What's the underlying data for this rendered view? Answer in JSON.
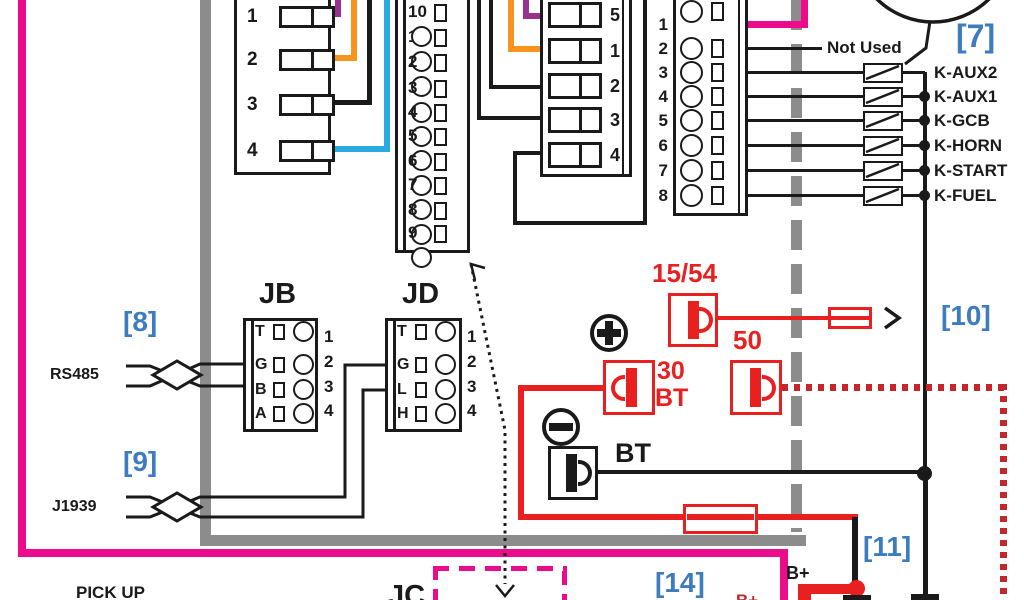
{
  "colors": {
    "magenta": "#ec0b8a",
    "gray": "#8c8c8c",
    "red": "#e8201f",
    "dark_red": "#c1272d",
    "blue_label": "#3d7dbf",
    "purple": "#97338f",
    "orange": "#f7941d",
    "light_blue": "#29abe2",
    "black": "#1a1a1a"
  },
  "labels": {
    "not_used": "Not Used",
    "pick_up": "PICK UP",
    "rs485": "RS485",
    "j1939": "J1939",
    "jb": "JB",
    "jd": "JD",
    "jc": "JC",
    "ref7": "[7]",
    "ref8": "[8]",
    "ref9": "[9]",
    "ref10": "[10]",
    "ref11": "[11]",
    "ref14": "[14]",
    "key_15_54": "15/54",
    "key_50": "50",
    "key_30": "30",
    "key_30_bt": "BT",
    "bt": "BT",
    "b_plus": "B+",
    "b_plus_partial": "B+"
  },
  "relays": [
    "K-AUX2",
    "K-AUX1",
    "K-GCB",
    "K-HORN",
    "K-START",
    "K-FUEL"
  ],
  "blocks": {
    "left4_pins": [
      "1",
      "2",
      "3",
      "4"
    ],
    "mid10_pins": [
      "1",
      "2",
      "3",
      "4",
      "5",
      "6",
      "7",
      "8",
      "9",
      "10"
    ],
    "mid5_pins": [
      "1",
      "2",
      "3",
      "4",
      "5"
    ],
    "right8_pins": [
      "1",
      "2",
      "3",
      "4",
      "5",
      "6",
      "7",
      "8"
    ],
    "jb_letters": [
      "G",
      "B",
      "A",
      "T"
    ],
    "jb_pins": [
      "1",
      "2",
      "3",
      "4"
    ],
    "jd_letters": [
      "G",
      "L",
      "H",
      "T"
    ],
    "jd_pins": [
      "1",
      "2",
      "3",
      "4"
    ]
  }
}
